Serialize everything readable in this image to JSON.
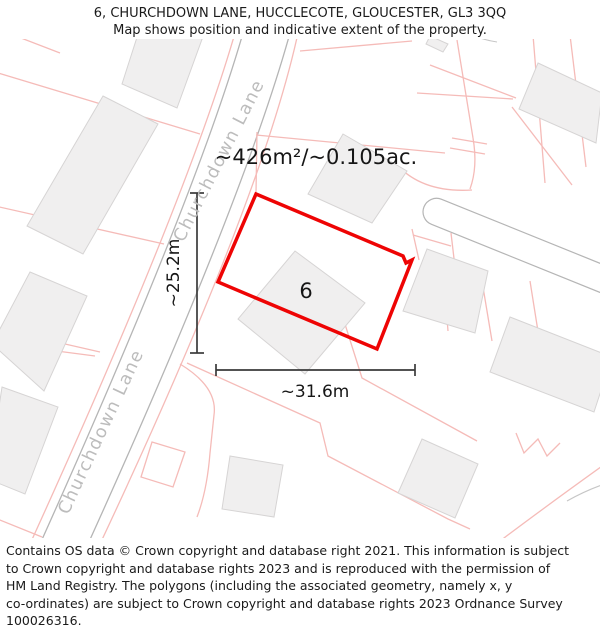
{
  "header": {
    "address": "6, CHURCHDOWN LANE, HUCCLECOTE, GLOUCESTER, GL3 3QQ",
    "description": "Map shows position and indicative extent of the property."
  },
  "map": {
    "area_label": "~426m²/~0.105ac.",
    "plot_number": "6",
    "width_label": "~31.6m",
    "height_label": "~25.2m",
    "street_label_upper": "Churchdown Lane",
    "street_label_lower": "Churchdown Lane",
    "colors": {
      "plot_outline": "#ee0404",
      "parcel_line": "#f5bbb8",
      "building_fill": "#f0efef",
      "building_stroke": "#d6d4d4",
      "road_edge": "#b5b5b5",
      "street_label": "#bcbcbc",
      "measure": "#3a3a3a"
    }
  },
  "footer": {
    "lines": [
      "Contains OS data © Crown copyright and database right 2021. This information is subject",
      "to Crown copyright and database rights 2023 and is reproduced with the permission of",
      "HM Land Registry. The polygons (including the associated geometry, namely x, y",
      "co-ordinates) are subject to Crown copyright and database rights 2023 Ordnance Survey",
      "100026316."
    ]
  }
}
